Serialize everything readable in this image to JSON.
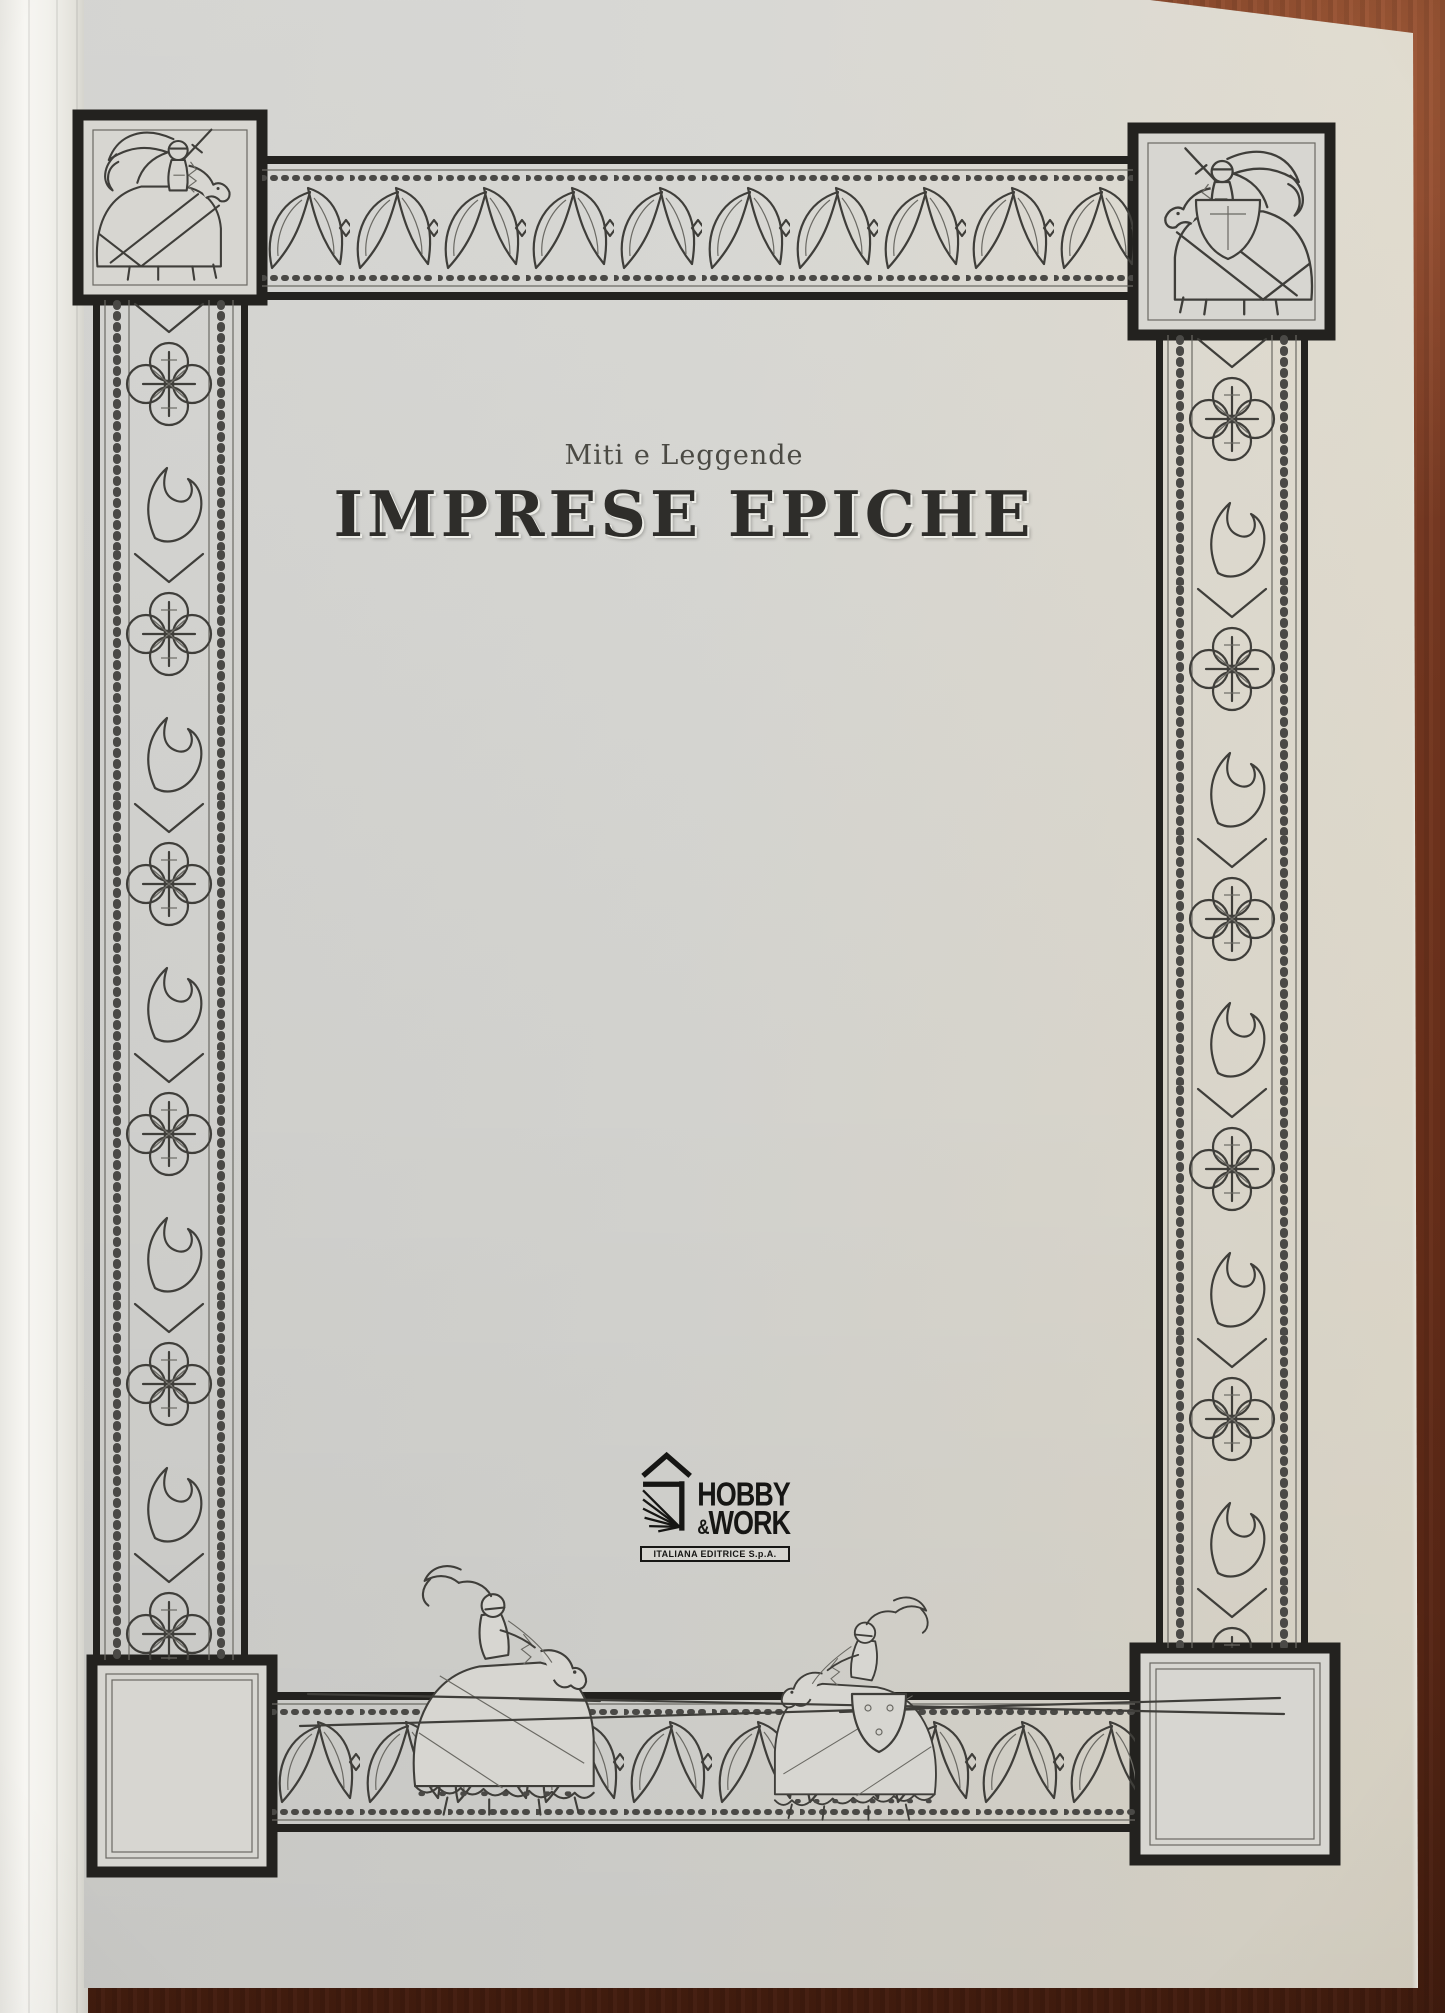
{
  "book": {
    "series": "Miti e Leggende",
    "title": "IMPRESE EPICHE"
  },
  "publisher": {
    "name_top": "HOBBY",
    "ampersand": "&",
    "name_bottom": "WORK",
    "subtitle": "ITALIANA EDITRICE S.p.A."
  },
  "colors": {
    "wood_table": "#73361f",
    "paper": "#d7d6d1",
    "ink": "#3f3e3a",
    "frame_black": "#23221f"
  },
  "decorations": {
    "top_left_corner": "knight-on-horseback-with-flowing-banner",
    "top_right_corner": "knight-on-horseback-with-shield",
    "bottom_scene": "two-jousting-knights-with-crossed-lances",
    "bottom_left_corner": "empty-panel",
    "bottom_right_corner": "empty-panel",
    "side_borders": "ornamental-foliate-and-cross-medallion-bands"
  }
}
